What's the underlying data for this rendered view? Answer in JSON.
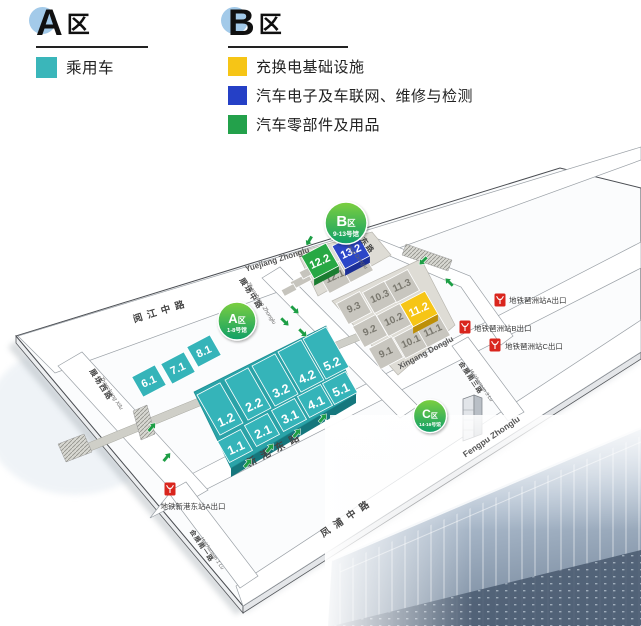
{
  "legend": {
    "a": {
      "letter": "A",
      "suffix": "区",
      "items": [
        {
          "label": "乘用车",
          "color": "#3ab6ba"
        }
      ]
    },
    "b": {
      "letter": "B",
      "suffix": "区",
      "items": [
        {
          "label": "充换电基础设施",
          "color": "#f6c516"
        },
        {
          "label": "汽车电子及车联网、维修与检测",
          "color": "#2540c6"
        },
        {
          "label": "汽车零部件及用品",
          "color": "#23a14b"
        }
      ]
    }
  },
  "badges": {
    "a": {
      "zone": "A",
      "suffix": "区",
      "halls": "1-8号馆"
    },
    "b": {
      "zone": "B",
      "suffix": "区",
      "halls": "9-13号馆"
    },
    "c": {
      "zone": "C",
      "suffix": "区",
      "halls": "14-16号馆"
    }
  },
  "roads": {
    "yuejiang_cn": "阅江中路",
    "yuejiang_py": "Yuejiang Zhonglu",
    "zhanchang_xilu_cn": "展场西路",
    "zhanchang_xilu_py": "Zhanchang Xilu",
    "zhanchang_zhonglu_cn": "展场中路",
    "zhanchang_zhonglu_py": "Zhanchang Zhonglu",
    "zhanchang_donglu_cn": "展场东路",
    "zhanchang_donglu_py": "Zhanchang Donglu",
    "xingang_cn": "新港东路",
    "xingang_py": "Xingang Donglu",
    "fengpu_cn": "凤浦中路",
    "fengpu_py": "Fengpu Zhonglu",
    "huizhannan1_cn": "会展南一路",
    "huizhannan1_py": "Huizhannan 1 Lu",
    "huizhannan3_cn": "会展南三路",
    "huizhannan3_py": "Huizhannan 3 Lu"
  },
  "metro": {
    "pazhou_a": "地铁琶洲站A出口",
    "pazhou_b": "地铁琶洲站B出口",
    "pazhou_c": "地铁琶洲站C出口",
    "xingangdong_a": "地铁新港东站A出口"
  },
  "map": {
    "halls": [
      {
        "label": "",
        "x": 301,
        "y": 281,
        "w": 20,
        "d": 8,
        "fill": "#c6c4bd"
      },
      {
        "label": "",
        "x": 310,
        "y": 271,
        "w": 20,
        "d": 8,
        "fill": "#c6c4bd"
      },
      {
        "label": "",
        "x": 289,
        "y": 290,
        "w": 14,
        "d": 7,
        "fill": "#c6c4bd"
      },
      {
        "label": "9.3",
        "x": 354,
        "y": 308,
        "w": 26,
        "d": 24,
        "fill": "#c8c6bf",
        "tc": "#7a786f",
        "ts": 10
      },
      {
        "label": "10.3",
        "x": 380,
        "y": 297,
        "w": 26,
        "d": 24,
        "fill": "#c8c6bf",
        "tc": "#7a786f",
        "ts": 10
      },
      {
        "label": "11.3",
        "x": 402,
        "y": 286,
        "w": 26,
        "d": 24,
        "fill": "#c8c6bf",
        "tc": "#7a786f",
        "ts": 10
      },
      {
        "label": "9.2",
        "x": 370,
        "y": 331,
        "w": 26,
        "d": 24,
        "fill": "#c8c6bf",
        "tc": "#7a786f",
        "ts": 10
      },
      {
        "label": "10.2",
        "x": 394,
        "y": 320,
        "w": 26,
        "d": 24,
        "fill": "#c8c6bf",
        "tc": "#7a786f",
        "ts": 10
      },
      {
        "label": "9.1",
        "x": 386,
        "y": 353,
        "w": 26,
        "d": 24,
        "fill": "#c8c6bf",
        "tc": "#7a786f",
        "ts": 10
      },
      {
        "label": "10.1",
        "x": 411,
        "y": 342,
        "w": 26,
        "d": 24,
        "fill": "#c8c6bf",
        "tc": "#7a786f",
        "ts": 10
      },
      {
        "label": "11.1",
        "x": 433,
        "y": 331,
        "w": 26,
        "d": 24,
        "fill": "#c8c6bf",
        "tc": "#7a786f",
        "ts": 10
      },
      {
        "label": "12.1",
        "x": 335,
        "y": 277,
        "w": 26,
        "d": 24,
        "fill": "#c8c6bf",
        "tc": "#7a786f",
        "ts": 10
      },
      {
        "label": "13.1",
        "x": 356,
        "y": 266,
        "w": 26,
        "d": 24,
        "fill": "#c8c6bf",
        "tc": "#7a786f",
        "ts": 10
      },
      {
        "label": "6.1",
        "x": 149,
        "y": 381,
        "w": 26,
        "d": 23,
        "fill": "#35b4b9",
        "ts": 11,
        "tdy": 1
      },
      {
        "label": "7.1",
        "x": 178,
        "y": 368,
        "w": 26,
        "d": 23,
        "fill": "#35b4b9",
        "ts": 11,
        "tdy": 1
      },
      {
        "label": "8.1",
        "x": 204,
        "y": 351,
        "w": 26,
        "d": 23,
        "fill": "#35b4b9",
        "ts": 11,
        "tdy": 1
      },
      {
        "label": "1.2",
        "x": 220,
        "y": 409,
        "w": 26,
        "d": 46,
        "fill": "#35b4b9",
        "ts": 12.5,
        "tdx": 6,
        "tdy": 11
      },
      {
        "label": "2.2",
        "x": 248,
        "y": 394,
        "w": 26,
        "d": 46,
        "fill": "#35b4b9",
        "ts": 12.5,
        "tdx": 6,
        "tdy": 11
      },
      {
        "label": "3.2",
        "x": 275,
        "y": 380,
        "w": 26,
        "d": 46,
        "fill": "#35b4b9",
        "ts": 12.5,
        "tdx": 6,
        "tdy": 11
      },
      {
        "label": "4.2",
        "x": 301,
        "y": 366,
        "w": 26,
        "d": 46,
        "fill": "#35b4b9",
        "ts": 12.5,
        "tdx": 6,
        "tdy": 11
      },
      {
        "label": "5.2",
        "x": 326,
        "y": 353,
        "w": 26,
        "d": 46,
        "fill": "#35b4b9",
        "ts": 12.5,
        "tdx": 6,
        "tdy": 11
      },
      {
        "label": "1.1",
        "x": 235,
        "y": 446,
        "w": 26,
        "d": 24,
        "fill": "#35b4b9",
        "ts": 12.5,
        "tdx": 1,
        "tdy": 2
      },
      {
        "label": "2.1",
        "x": 262,
        "y": 430,
        "w": 26,
        "d": 24,
        "fill": "#35b4b9",
        "ts": 12.5,
        "tdx": 1,
        "tdy": 2
      },
      {
        "label": "3.1",
        "x": 289,
        "y": 415,
        "w": 26,
        "d": 24,
        "fill": "#35b4b9",
        "ts": 12.5,
        "tdx": 1,
        "tdy": 2
      },
      {
        "label": "4.1",
        "x": 315,
        "y": 401,
        "w": 26,
        "d": 24,
        "fill": "#35b4b9",
        "ts": 12.5,
        "tdx": 1,
        "tdy": 2
      },
      {
        "label": "5.1",
        "x": 340,
        "y": 388,
        "w": 26,
        "d": 24,
        "fill": "#35b4b9",
        "ts": 12.5,
        "tdx": 1,
        "tdy": 2
      },
      {
        "label": "12.2",
        "x": 320,
        "y": 261,
        "w": 28,
        "d": 26,
        "fill": "#27a844",
        "side": "#1b7d31",
        "ts": 11,
        "tdy": 1
      },
      {
        "label": "13.2",
        "x": 351,
        "y": 251,
        "w": 28,
        "d": 26,
        "fill": "#2b46c8",
        "side": "#1b2f97",
        "ts": 11,
        "tdy": 1
      },
      {
        "label": "11.2",
        "x": 419,
        "y": 309,
        "w": 28,
        "d": 26,
        "fill": "#f6c516",
        "side": "#bd8f09",
        "ts": 11,
        "tdy": 1
      }
    ],
    "arrows": [
      {
        "x": 309,
        "y": 241,
        "r": 210
      },
      {
        "x": 423,
        "y": 261,
        "r": 225
      },
      {
        "x": 449,
        "y": 282,
        "r": 315
      },
      {
        "x": 295,
        "y": 310,
        "r": 135
      },
      {
        "x": 285,
        "y": 322,
        "r": 135
      },
      {
        "x": 303,
        "y": 333,
        "r": 135
      },
      {
        "x": 152,
        "y": 427,
        "r": 40
      },
      {
        "x": 167,
        "y": 457,
        "r": 40
      },
      {
        "x": 248,
        "y": 463,
        "r": 40
      },
      {
        "x": 270,
        "y": 448,
        "r": 40
      },
      {
        "x": 297,
        "y": 433,
        "r": 40
      },
      {
        "x": 323,
        "y": 418,
        "r": 40
      }
    ],
    "arrow_color": "#1d9e45"
  }
}
